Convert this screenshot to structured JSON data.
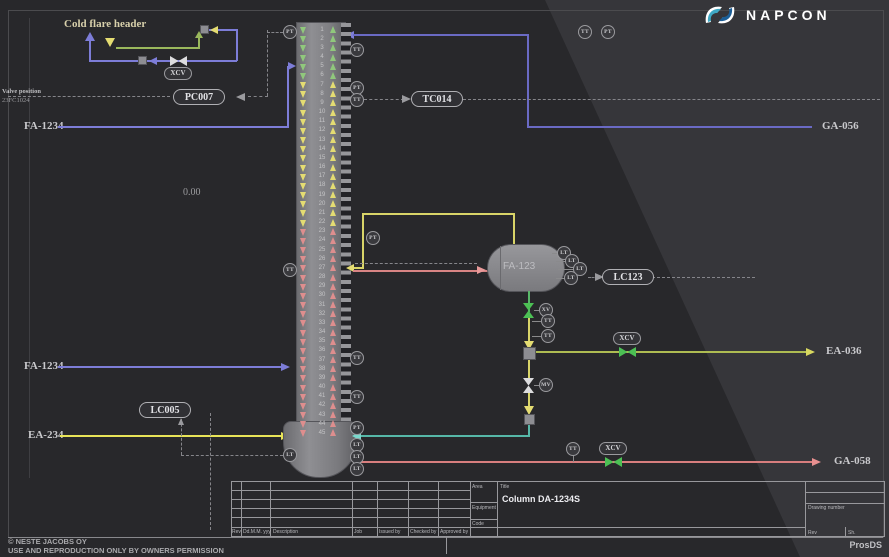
{
  "logo": {
    "name": "NAPCON"
  },
  "product": "ProsDS",
  "annotations": {
    "cold_flare": "Cold flare header",
    "valve_position": "Valve position",
    "valve_tag": "23FC1024",
    "zero_value": "0.00"
  },
  "streams": {
    "fa1234_top": "FA-1234",
    "ga056": "GA-056",
    "fa1234_bottom": "FA-1234",
    "ea234": "EA-234",
    "ea036": "EA-036",
    "ga058": "GA-058"
  },
  "equipment": {
    "drum": "FA-123"
  },
  "column": {
    "tray_count": 45,
    "zones": [
      {
        "from": 1,
        "to": 6,
        "color": "#90c87c"
      },
      {
        "from": 7,
        "to": 22,
        "color": "#e4dc72"
      },
      {
        "from": 23,
        "to": 45,
        "color": "#de8e8e"
      }
    ]
  },
  "instruments": [
    {
      "tag": "PT",
      "x": 290,
      "y": 32
    },
    {
      "tag": "TT",
      "x": 357,
      "y": 50
    },
    {
      "tag": "PT",
      "x": 357,
      "y": 88
    },
    {
      "tag": "TT",
      "x": 357,
      "y": 100
    },
    {
      "tag": "TT",
      "x": 585,
      "y": 32
    },
    {
      "tag": "PT",
      "x": 608,
      "y": 32
    },
    {
      "tag": "PT",
      "x": 373,
      "y": 238
    },
    {
      "tag": "TT",
      "x": 290,
      "y": 270
    },
    {
      "tag": "TT",
      "x": 357,
      "y": 358
    },
    {
      "tag": "TT",
      "x": 357,
      "y": 397
    },
    {
      "tag": "PT",
      "x": 357,
      "y": 428
    },
    {
      "tag": "LT",
      "x": 357,
      "y": 445
    },
    {
      "tag": "LT",
      "x": 357,
      "y": 457
    },
    {
      "tag": "LT",
      "x": 357,
      "y": 469
    },
    {
      "tag": "LT",
      "x": 290,
      "y": 455
    },
    {
      "tag": "LT",
      "x": 564,
      "y": 253
    },
    {
      "tag": "LT",
      "x": 572,
      "y": 261
    },
    {
      "tag": "LT",
      "x": 580,
      "y": 269
    },
    {
      "tag": "LT",
      "x": 571,
      "y": 278
    },
    {
      "tag": "XV",
      "x": 546,
      "y": 310
    },
    {
      "tag": "TT",
      "x": 548,
      "y": 321
    },
    {
      "tag": "TT",
      "x": 548,
      "y": 336
    },
    {
      "tag": "MV",
      "x": 546,
      "y": 385
    },
    {
      "tag": "TT",
      "x": 573,
      "y": 449
    }
  ],
  "controllers": [
    {
      "tag": "PC007",
      "x": 199,
      "y": 97
    },
    {
      "tag": "TC014",
      "x": 437,
      "y": 99
    },
    {
      "tag": "LC123",
      "x": 628,
      "y": 277
    },
    {
      "tag": "LC005",
      "x": 165,
      "y": 410
    }
  ],
  "valve_tags": [
    {
      "tag": "XCV",
      "x": 178,
      "y": 73
    },
    {
      "tag": "XCV",
      "x": 627,
      "y": 338
    },
    {
      "tag": "XCV",
      "x": 613,
      "y": 448
    }
  ],
  "titleblock": {
    "headers": [
      "Rev",
      "Dd.M.M. yyy",
      "Description",
      "Job",
      "Issued by",
      "Checked by",
      "Approved by"
    ],
    "area_label": "Area",
    "equipment_label": "Equipment",
    "code_label": "Code",
    "title_label": "Title",
    "title_value": "Column DA-1234S",
    "drawing_number_label": "Drawing number",
    "rev_label": "Rev",
    "sheet_label": "Sh."
  },
  "footer": {
    "copyright": "© NESTE JACOBS OY",
    "permission": "USE AND REPRODUCTION ONLY BY OWNERS PERMISSION"
  }
}
